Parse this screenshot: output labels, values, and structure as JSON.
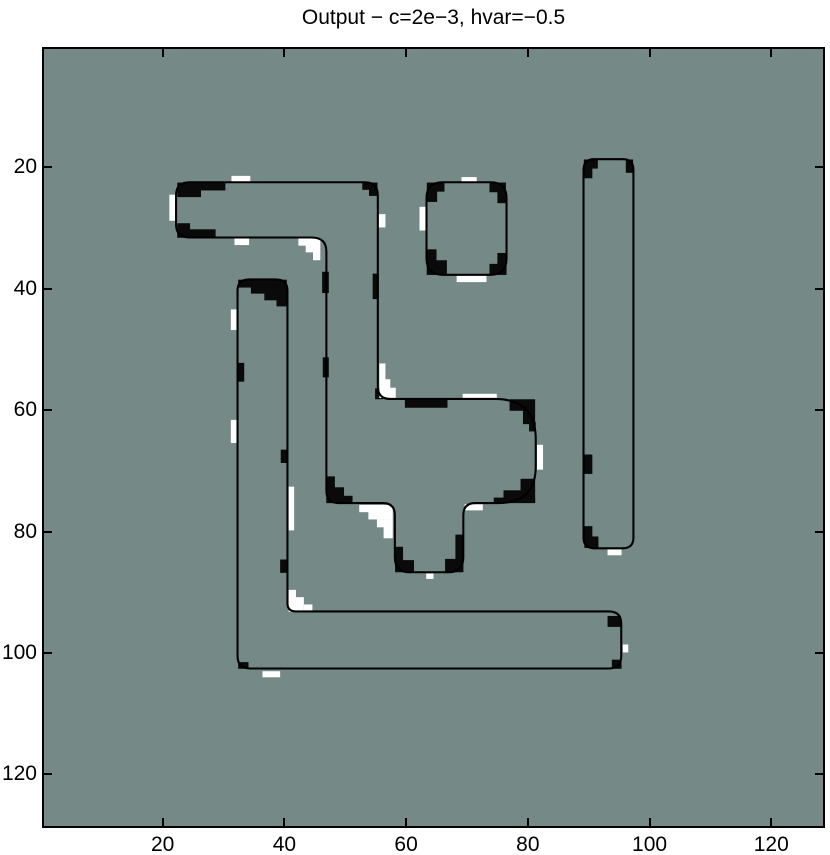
{
  "figure": {
    "title": "Output − c=2e−3, hvar=−0.5"
  },
  "chart_data": {
    "type": "heatmap",
    "title": "Output − c=2e−3, hvar=−0.5",
    "xlabel": "",
    "ylabel": "",
    "image_size": [
      128,
      128
    ],
    "x_ticks": [
      20,
      40,
      60,
      80,
      100,
      120
    ],
    "y_ticks": [
      20,
      40,
      60,
      80,
      100,
      120
    ],
    "x_range": [
      0.5,
      128.5
    ],
    "y_range": [
      0.5,
      128.5
    ],
    "grid": false,
    "legend": "none",
    "colors": {
      "background": "#758987",
      "contour": "#000000",
      "patch_black": "#0a0a0a",
      "patch_white": "#ffffff"
    },
    "contours": [
      {
        "name": "bar-hook-blob-funnel",
        "d": "M 22.2 24.6 Q 22.2 22.45 24.4 22.45 L 53.2 22.45 Q 55.35 22.45 55.35 24.6 L 55.35 56.1 Q 55.35 58.15 57.4 58.15 L 74.6 58.15 Q 81.3 58.15 81.3 64.8 L 81.3 69.2 Q 81.3 75.3 75.2 75.3 L 71.4 75.3 Q 69.4 75.3 69.4 77.3 L 69.4 84.2 Q 69.4 86.7 66.9 86.7 L 60.6 86.7 Q 58.15 86.7 58.15 84.2 L 58.15 77.3 Q 58.15 75.3 56.15 75.3 L 48.9 75.3 Q 46.9 75.3 46.9 73.3 L 46.9 33.9 Q 46.9 31.55 44.5 31.55 L 24.4 31.55 Q 22.2 31.55 22.2 29.4 Z"
      },
      {
        "name": "l-shape",
        "d": "M 32.3 40.3 Q 32.3 38.45 34.2 38.45 L 38.6 38.45 Q 40.5 38.45 40.5 40.3 L 40.5 91.8 Q 40.5 93.15 41.9 93.15 L 93.3 93.15 Q 95.35 93.15 95.35 95.2 L 95.35 100.5 Q 95.35 102.55 93.3 102.55 L 34.4 102.55 Q 32.3 102.55 32.3 100.5 Z"
      },
      {
        "name": "small-square",
        "d": "M 63.35 25.1 Q 63.35 22.45 66.0 22.45 L 73.9 22.45 Q 76.5 22.45 76.5 25.1 L 76.5 35.0 Q 76.5 37.7 73.9 37.7 L 66.0 37.7 Q 63.35 37.7 63.35 35.0 Z"
      },
      {
        "name": "right-tall-rect",
        "d": "M 89.15 20.4 Q 89.15 18.65 90.9 18.65 L 95.6 18.65 Q 97.35 18.65 97.35 20.4 L 97.35 81.0 Q 97.35 82.75 95.6 82.75 L 90.9 82.75 Q 89.15 82.75 89.15 81.0 Z"
      }
    ],
    "black_patches": [
      [
        22.4,
        22.5,
        7.9,
        1.3
      ],
      [
        22.4,
        23.6,
        3.9,
        1.3
      ],
      [
        52.8,
        22.5,
        2.5,
        1.2
      ],
      [
        53.9,
        23.5,
        1.4,
        1.2
      ],
      [
        22.4,
        29.2,
        2.1,
        2.3
      ],
      [
        22.4,
        30.2,
        6.3,
        1.4
      ],
      [
        54.5,
        37.5,
        1.0,
        4.2
      ],
      [
        46.2,
        37.2,
        1.1,
        3.5
      ],
      [
        46.3,
        51.3,
        1.0,
        3.3
      ],
      [
        54.9,
        56.4,
        1.3,
        1.8
      ],
      [
        59.8,
        58.2,
        7.0,
        1.4
      ],
      [
        77.0,
        58.2,
        4.2,
        1.9
      ],
      [
        79.2,
        59.9,
        2.0,
        2.4
      ],
      [
        80.2,
        61.9,
        1.1,
        1.6
      ],
      [
        78.8,
        71.3,
        2.4,
        2.1
      ],
      [
        76.0,
        73.2,
        5.2,
        2.1
      ],
      [
        74.4,
        74.4,
        6.8,
        0.9
      ],
      [
        46.9,
        70.9,
        1.4,
        4.4
      ],
      [
        46.9,
        72.7,
        2.9,
        2.6
      ],
      [
        46.9,
        74.1,
        4.3,
        1.2
      ],
      [
        58.2,
        82.5,
        1.3,
        4.1
      ],
      [
        58.2,
        84.7,
        3.1,
        2.0
      ],
      [
        68.1,
        80.5,
        1.3,
        6.1
      ],
      [
        66.4,
        84.5,
        3.0,
        2.2
      ],
      [
        32.4,
        38.5,
        8.0,
        1.3
      ],
      [
        34.5,
        39.6,
        5.9,
        1.2
      ],
      [
        36.7,
        40.7,
        3.7,
        1.2
      ],
      [
        38.7,
        41.8,
        1.7,
        1.1
      ],
      [
        32.3,
        52.2,
        1.1,
        3.1
      ],
      [
        39.4,
        66.5,
        1.1,
        2.2
      ],
      [
        39.3,
        84.6,
        1.1,
        2.2
      ],
      [
        93.1,
        93.9,
        2.2,
        1.8
      ],
      [
        93.8,
        101.1,
        1.6,
        1.5
      ],
      [
        32.4,
        101.5,
        1.7,
        1.1
      ],
      [
        63.4,
        22.5,
        2.9,
        1.5
      ],
      [
        63.4,
        23.7,
        1.7,
        2.0
      ],
      [
        73.7,
        22.5,
        2.7,
        1.6
      ],
      [
        75.0,
        23.9,
        1.5,
        2.0
      ],
      [
        63.4,
        33.5,
        1.6,
        4.2
      ],
      [
        63.4,
        35.3,
        3.3,
        2.4
      ],
      [
        75.0,
        34.1,
        1.5,
        3.6
      ],
      [
        73.7,
        35.9,
        2.8,
        1.8
      ],
      [
        89.2,
        18.7,
        2.3,
        1.5
      ],
      [
        89.2,
        19.9,
        1.4,
        1.9
      ],
      [
        96.1,
        18.7,
        1.2,
        2.2
      ],
      [
        89.2,
        67.3,
        1.4,
        3.2
      ],
      [
        89.3,
        79.1,
        1.3,
        3.5
      ],
      [
        89.3,
        80.8,
        2.3,
        1.9
      ]
    ],
    "white_patches": [
      [
        31.3,
        21.4,
        3.1,
        1.1
      ],
      [
        21.1,
        24.5,
        1.1,
        4.3
      ],
      [
        55.5,
        27.7,
        1.1,
        2.2
      ],
      [
        31.8,
        31.6,
        2.4,
        1.2
      ],
      [
        42.3,
        31.7,
        3.6,
        1.2
      ],
      [
        43.5,
        32.8,
        2.4,
        1.2
      ],
      [
        44.7,
        33.9,
        1.2,
        1.4
      ],
      [
        55.6,
        52.3,
        1.0,
        5.7
      ],
      [
        56.5,
        54.9,
        0.9,
        3.1
      ],
      [
        57.3,
        56.3,
        1.0,
        1.7
      ],
      [
        69.3,
        57.3,
        5.6,
        0.9
      ],
      [
        81.5,
        65.7,
        1.0,
        4.1
      ],
      [
        69.6,
        75.5,
        3.0,
        1.0
      ],
      [
        52.3,
        75.6,
        5.5,
        1.2
      ],
      [
        53.8,
        76.7,
        4.0,
        1.3
      ],
      [
        55.2,
        78.0,
        2.6,
        1.3
      ],
      [
        56.3,
        79.2,
        1.5,
        1.9
      ],
      [
        63.3,
        86.9,
        1.2,
        0.9
      ],
      [
        31.2,
        43.4,
        1.0,
        3.4
      ],
      [
        31.2,
        61.6,
        1.0,
        3.8
      ],
      [
        40.7,
        72.6,
        0.9,
        7.2
      ],
      [
        40.7,
        89.6,
        1.2,
        3.6
      ],
      [
        41.9,
        90.8,
        1.3,
        2.4
      ],
      [
        43.2,
        92.0,
        1.4,
        1.2
      ],
      [
        95.6,
        98.6,
        0.9,
        1.3
      ],
      [
        36.4,
        103.0,
        2.9,
        1.0
      ],
      [
        69.1,
        21.6,
        2.5,
        0.9
      ],
      [
        62.2,
        26.5,
        1.1,
        3.9
      ],
      [
        68.3,
        37.8,
        4.9,
        1.1
      ],
      [
        93.1,
        82.9,
        2.3,
        1.0
      ]
    ]
  }
}
